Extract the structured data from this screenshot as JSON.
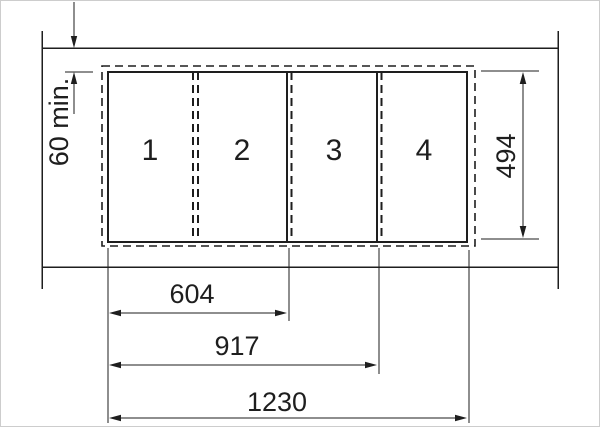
{
  "diagram": {
    "panes": [
      {
        "label": "1"
      },
      {
        "label": "2"
      },
      {
        "label": "3"
      },
      {
        "label": "4"
      }
    ],
    "dimensions": {
      "top_clearance": "60 min.",
      "pane_height": "494",
      "width_to_pane_2": "604",
      "width_to_pane_3": "917",
      "width_to_pane_4": "1230"
    },
    "colors": {
      "line": "#1e1e1e",
      "background": "#ffffff",
      "edge": "#cdcdcd"
    }
  }
}
